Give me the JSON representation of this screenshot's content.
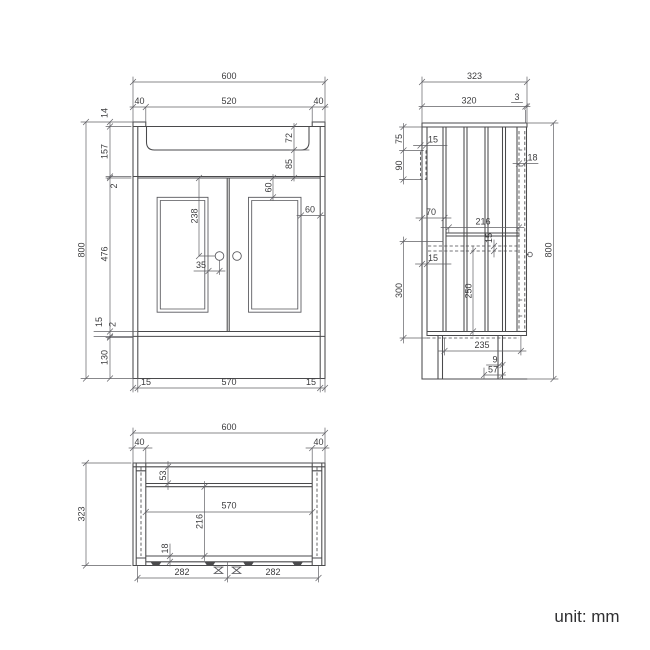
{
  "unit_label": "unit: mm",
  "front": {
    "overall_width": "600",
    "left_upstand_width": "40",
    "basin_width": "520",
    "right_upstand_width": "40",
    "upstand_height": "14",
    "top_section_height": "157",
    "top_gap": "2",
    "basin_depth": "72",
    "basin_to_door": "85",
    "door_height": "476",
    "bottom_rail": "15",
    "bottom_gap": "2",
    "plinth_height": "130",
    "overall_height": "800",
    "panel_top_inset": "60",
    "panel_side_inset": "60",
    "handle_drop": "238",
    "handle_offset": "35",
    "left_side_thickness": "15",
    "internal_width": "570",
    "right_side_thickness": "15"
  },
  "side": {
    "overall_depth": "323",
    "top_depth": "320",
    "front_lip": "3",
    "hinge_top_offset": "75",
    "hinge_plate_height": "90",
    "hinge_plate_width": "15",
    "door_thickness": "18",
    "back_offset": "70",
    "internal_depth": "216",
    "shelf_thickness": "15",
    "back_panel_thickness": "15",
    "shelf_to_base": "300",
    "under_shelf_clearance": "250",
    "overall_height": "800",
    "plinth_depth": "235",
    "foot_gap": "9",
    "foot_recess": "57"
  },
  "plan": {
    "overall_width": "600",
    "left_corner_width": "40",
    "right_corner_width": "40",
    "back_rail_depth": "53",
    "internal_width": "570",
    "internal_depth": "216",
    "door_thickness": "18",
    "overall_depth": "323",
    "left_foot_span": "282",
    "right_foot_span": "282"
  }
}
